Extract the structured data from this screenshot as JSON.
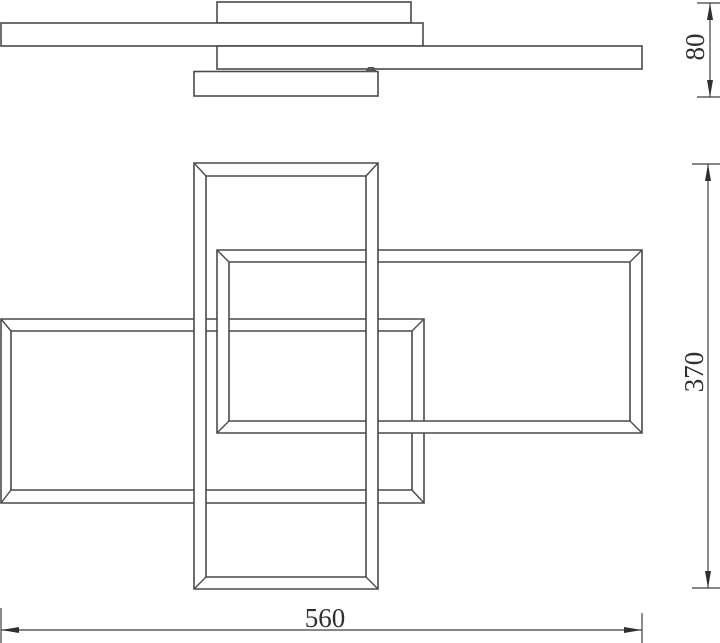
{
  "diagram": {
    "type": "technical-dimension-drawing",
    "subject": "ceiling-lamp-three-rectangular-frames",
    "dimensions": {
      "profile_height": {
        "label": "80"
      },
      "overall_height": {
        "label": "370"
      },
      "overall_width": {
        "label": "560"
      }
    },
    "colors": {
      "background": "#ffffff",
      "object_line": "#4a4a4a",
      "dimension_line": "#3f3f3f",
      "text": "#2f2f2f",
      "connector": "#555555"
    }
  }
}
